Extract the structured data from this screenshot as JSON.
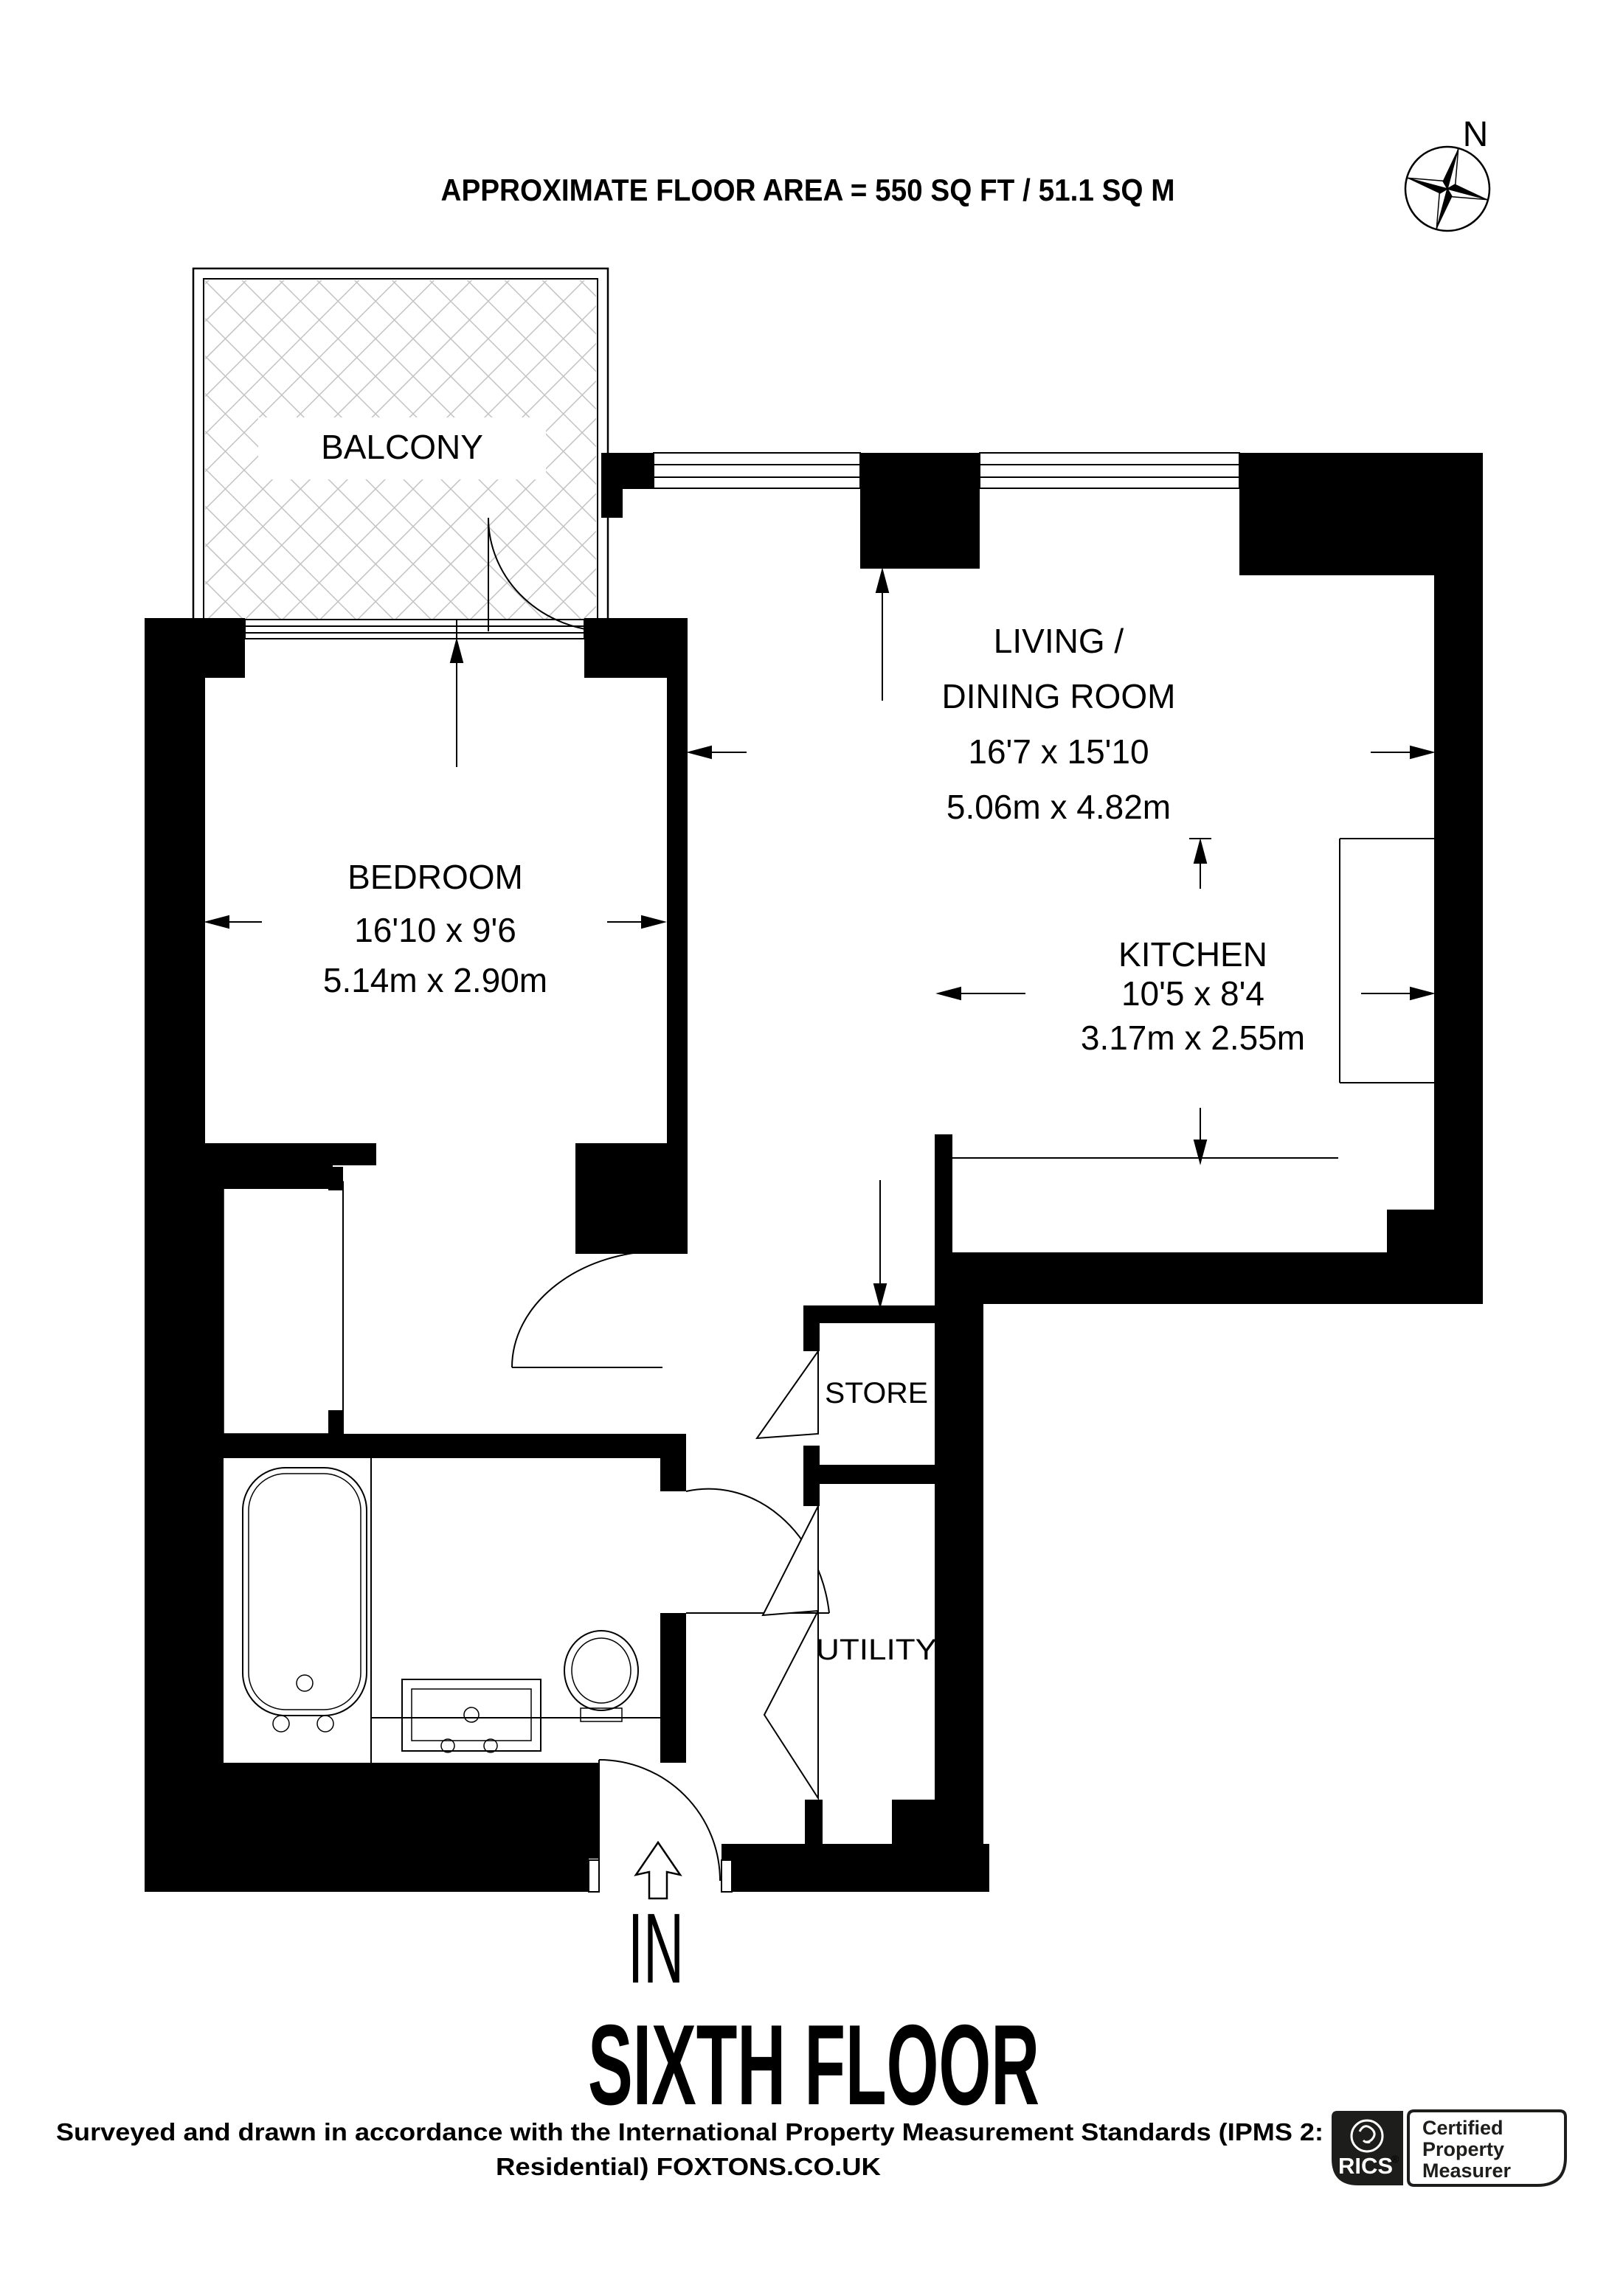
{
  "header": {
    "floor_area": "APPROXIMATE FLOOR AREA = 550 SQ FT / 51.1 SQ M"
  },
  "compass": {
    "north_label": "N"
  },
  "rooms": {
    "balcony": {
      "name": "BALCONY"
    },
    "bedroom": {
      "name": "BEDROOM",
      "dims_imperial": "16'10 x 9'6",
      "dims_metric": "5.14m x 2.90m"
    },
    "living": {
      "name_line1": "LIVING /",
      "name_line2": "DINING ROOM",
      "dims_imperial": "16'7 x 15'10",
      "dims_metric": "5.06m x 4.82m"
    },
    "kitchen": {
      "name": "KITCHEN",
      "dims_imperial": "10'5 x 8'4",
      "dims_metric": "3.17m x 2.55m"
    },
    "store": {
      "name": "STORE"
    },
    "utility": {
      "name": "UTILITY"
    }
  },
  "entrance": {
    "label": "IN"
  },
  "floor_title": "SIXTH FLOOR",
  "footer": {
    "line1": "Surveyed and drawn in accordance with the International Property Measurement Standards (IPMS 2:",
    "line2": "Residential) FOXTONS.CO.UK"
  },
  "badge": {
    "org": "RICS",
    "reg": "®",
    "line1": "Certified",
    "line2": "Property",
    "line3": "Measurer"
  },
  "colors": {
    "wall": "#000000",
    "hatch": "#c3c3c3",
    "badge_bg": "#1d1d1b"
  }
}
